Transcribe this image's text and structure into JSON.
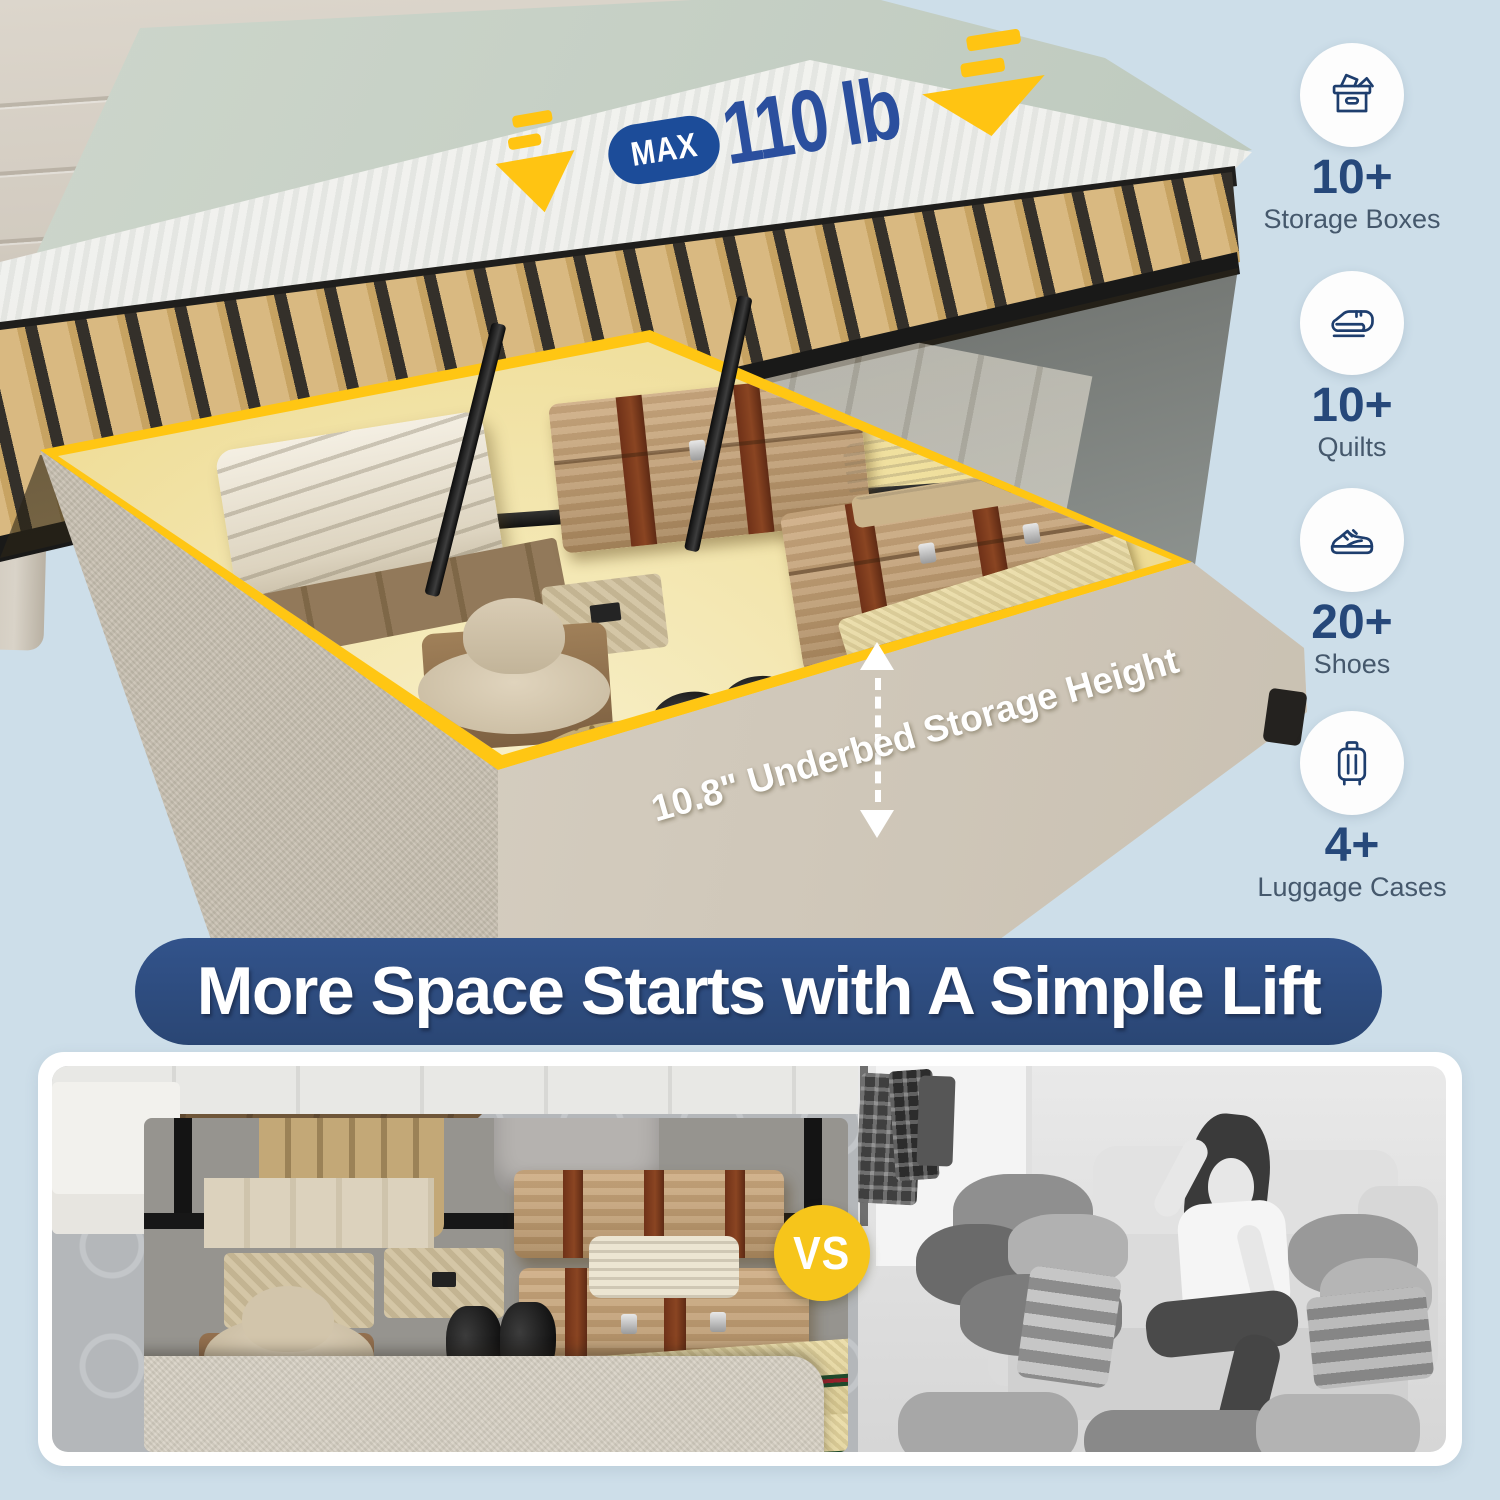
{
  "colors": {
    "background": "#cddee9",
    "banner_blue": "#2d4b7d",
    "pill_blue": "#1c4c99",
    "weight_blue": "#2b4f9e",
    "accent_yellow": "#ffc412",
    "vs_yellow": "#f6c51b",
    "storage_glow": "#efdd97",
    "navy_text": "#26487a",
    "label_gray": "#45586c",
    "base_beige": "#d6cfc1"
  },
  "scene": {
    "max_badge": {
      "label": "MAX",
      "value": "110 lb"
    },
    "storage_height_label": "10.8\" Underbed Storage Height"
  },
  "features": [
    {
      "icon": "storage-box-icon",
      "count": "10+",
      "label": "Storage Boxes"
    },
    {
      "icon": "quilt-icon",
      "count": "10+",
      "label": "Quilts"
    },
    {
      "icon": "sneaker-icon",
      "count": "20+",
      "label": "Shoes"
    },
    {
      "icon": "luggage-icon",
      "count": "4+",
      "label": "Luggage Cases"
    }
  ],
  "banner": {
    "title": "More Space Starts with A Simple Lift"
  },
  "comparison": {
    "vs_label": "VS"
  }
}
